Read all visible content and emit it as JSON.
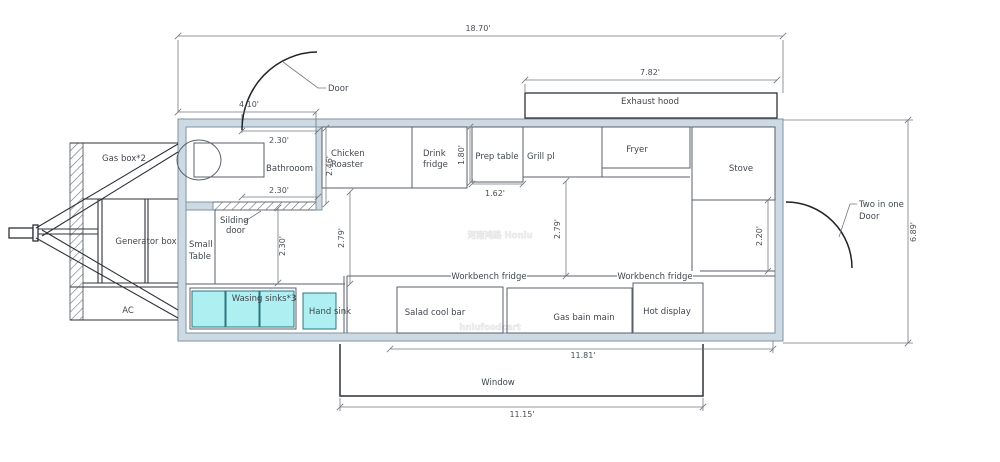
{
  "meta": {
    "description": "Food trailer floor plan CAD drawing",
    "width": 1000,
    "height": 462
  },
  "colors": {
    "wall_fill": "#cdd9e3",
    "wall_stroke": "#7f93a2",
    "unit_stroke": "#596068",
    "dark_stroke": "#2e3237",
    "dim_stroke": "#74797f",
    "sink_fill": "#aeeff1",
    "sink_stroke": "#2b7680",
    "text": "#41474e",
    "background": "#ffffff"
  },
  "walls": {
    "outer": {
      "x": 178,
      "y": 119,
      "w": 605,
      "h": 222
    },
    "inner": {
      "x": 186,
      "y": 127,
      "w": 589,
      "h": 206
    }
  },
  "boxes": [
    {
      "n": "annex-hatch-strip",
      "x": 70,
      "y": 143,
      "w": 13,
      "h": 177,
      "cls": "hatch"
    },
    {
      "n": "sliding-door-hatch",
      "x": 213,
      "y": 202,
      "w": 105,
      "h": 8,
      "cls": "hatch"
    },
    {
      "n": "bathroom-partition-wall",
      "x": 316,
      "y": 127,
      "w": 6,
      "h": 83,
      "cls": "wall"
    },
    {
      "n": "bathroom-wall-stub",
      "x": 186,
      "y": 202,
      "w": 27,
      "h": 8,
      "cls": "wall"
    },
    {
      "n": "toilet-tank",
      "x": 194,
      "y": 143,
      "w": 70,
      "h": 34,
      "cls": "unit-open"
    },
    {
      "n": "chicken-roaster-box",
      "x": 322,
      "y": 127,
      "w": 90,
      "h": 61,
      "cls": "unit"
    },
    {
      "n": "drink-fridge-box",
      "x": 412,
      "y": 127,
      "w": 55,
      "h": 61,
      "cls": "unit"
    },
    {
      "n": "prep-table-box",
      "x": 472,
      "y": 127,
      "w": 51,
      "h": 55,
      "cls": "unit"
    },
    {
      "n": "grill-box",
      "x": 523,
      "y": 127,
      "w": 79,
      "h": 50,
      "cls": "unit"
    },
    {
      "n": "fryer-box",
      "x": 602,
      "y": 127,
      "w": 88,
      "h": 41,
      "cls": "unit"
    },
    {
      "n": "stove-box",
      "x": 692,
      "y": 127,
      "w": 83,
      "h": 73,
      "cls": "unit"
    },
    {
      "n": "exhaust-hood-box",
      "x": 525,
      "y": 93,
      "w": 252,
      "h": 25,
      "cls": "dark"
    },
    {
      "n": "sink-unit-box",
      "x": 190,
      "y": 288,
      "w": 106,
      "h": 41,
      "cls": "unit"
    },
    {
      "n": "wash-sink-1",
      "x": 192,
      "y": 291,
      "w": 33,
      "h": 36,
      "cls": "sink"
    },
    {
      "n": "wash-sink-2",
      "x": 226,
      "y": 291,
      "w": 33,
      "h": 36,
      "cls": "sink"
    },
    {
      "n": "wash-sink-3",
      "x": 260,
      "y": 291,
      "w": 34,
      "h": 36,
      "cls": "sink"
    },
    {
      "n": "hand-sink-box",
      "x": 303,
      "y": 293,
      "w": 33,
      "h": 36,
      "cls": "sink"
    },
    {
      "n": "salad-cool-bar-box",
      "x": 397,
      "y": 287,
      "w": 106,
      "h": 46,
      "cls": "unit"
    },
    {
      "n": "gas-bain-main-box",
      "x": 507,
      "y": 288,
      "w": 125,
      "h": 45,
      "cls": "unit"
    },
    {
      "n": "hot-display-box",
      "x": 633,
      "y": 283,
      "w": 70,
      "h": 50,
      "cls": "unit"
    },
    {
      "n": "hitch-coupler",
      "x": 9,
      "y": 228,
      "w": 24,
      "h": 10,
      "cls": "dark"
    },
    {
      "n": "hitch-post",
      "x": 33,
      "y": 225,
      "w": 5,
      "h": 16,
      "cls": "dark"
    }
  ],
  "ellipses": [
    {
      "n": "toilet-bowl",
      "cx": 199,
      "cy": 160,
      "rx": 22,
      "ry": 20,
      "cls": "unit-open"
    }
  ],
  "lines": [
    {
      "n": "counter-edge-line",
      "x1": 186,
      "y1": 284,
      "x2": 345,
      "y2": 284,
      "cls": "line"
    },
    {
      "n": "small-table-divider",
      "x1": 215,
      "y1": 210,
      "x2": 215,
      "y2": 284,
      "cls": "line"
    },
    {
      "n": "fryer-front-line",
      "x1": 602,
      "y1": 177,
      "x2": 690,
      "y2": 177,
      "cls": "line"
    },
    {
      "n": "stove-front-line",
      "x1": 692,
      "y1": 200,
      "x2": 775,
      "y2": 200,
      "cls": "line"
    },
    {
      "n": "stove-counter-line",
      "x1": 692,
      "y1": 200,
      "x2": 692,
      "y2": 276,
      "cls": "line"
    },
    {
      "n": "workbench-top-line",
      "x1": 347,
      "y1": 276,
      "x2": 775,
      "y2": 276,
      "cls": "line"
    },
    {
      "n": "workbench-left-line-a",
      "x1": 344,
      "y1": 276,
      "x2": 344,
      "y2": 333,
      "cls": "line"
    },
    {
      "n": "workbench-left-line-b",
      "x1": 347,
      "y1": 276,
      "x2": 347,
      "y2": 333,
      "cls": "line"
    },
    {
      "n": "side-door-opening-line",
      "x1": 700,
      "y1": 271,
      "x2": 775,
      "y2": 271,
      "cls": "line"
    },
    {
      "n": "annex-top-line",
      "x1": 70,
      "y1": 143,
      "x2": 178,
      "y2": 143,
      "cls": "ann"
    },
    {
      "n": "annex-bottom-line",
      "x1": 70,
      "y1": 320,
      "x2": 178,
      "y2": 320,
      "cls": "ann"
    },
    {
      "n": "gasbox-bottom-line",
      "x1": 83,
      "y1": 199,
      "x2": 178,
      "y2": 199,
      "cls": "ann"
    },
    {
      "n": "generator-bottom-line",
      "x1": 83,
      "y1": 283,
      "x2": 178,
      "y2": 283,
      "cls": "ann"
    },
    {
      "n": "ac-top-line",
      "x1": 70,
      "y1": 287,
      "x2": 178,
      "y2": 287,
      "cls": "ann"
    },
    {
      "n": "frame-post-left-a",
      "x1": 98,
      "y1": 199,
      "x2": 98,
      "y2": 283,
      "cls": "ann"
    },
    {
      "n": "frame-post-left-b",
      "x1": 102,
      "y1": 199,
      "x2": 102,
      "y2": 283,
      "cls": "ann"
    },
    {
      "n": "frame-post-right-a",
      "x1": 145,
      "y1": 199,
      "x2": 145,
      "y2": 283,
      "cls": "ann"
    },
    {
      "n": "frame-post-right-b",
      "x1": 148,
      "y1": 199,
      "x2": 148,
      "y2": 283,
      "cls": "ann"
    },
    {
      "n": "drawbar-top",
      "x1": 38,
      "y1": 229,
      "x2": 98,
      "y2": 229,
      "cls": "ann"
    },
    {
      "n": "drawbar-bottom",
      "x1": 38,
      "y1": 234,
      "x2": 98,
      "y2": 234,
      "cls": "ann"
    },
    {
      "n": "hitch-beam-top-a",
      "x1": 36,
      "y1": 228,
      "x2": 178,
      "y2": 144,
      "cls": "ann"
    },
    {
      "n": "hitch-beam-top-b",
      "x1": 42,
      "y1": 236,
      "x2": 178,
      "y2": 152,
      "cls": "ann"
    },
    {
      "n": "hitch-beam-bottom-a",
      "x1": 36,
      "y1": 238,
      "x2": 178,
      "y2": 318,
      "cls": "ann"
    },
    {
      "n": "hitch-beam-bottom-b",
      "x1": 42,
      "y1": 230,
      "x2": 178,
      "y2": 310,
      "cls": "ann"
    },
    {
      "n": "ext-line-left-top",
      "x1": 178,
      "y1": 40,
      "x2": 178,
      "y2": 112,
      "cls": "dim"
    },
    {
      "n": "ext-line-right-top",
      "x1": 783,
      "y1": 40,
      "x2": 783,
      "y2": 93,
      "cls": "dim"
    },
    {
      "n": "ext-line-hood-left",
      "x1": 525,
      "y1": 84,
      "x2": 525,
      "y2": 93,
      "cls": "dim"
    },
    {
      "n": "ext-line-door-right",
      "x1": 316,
      "y1": 112,
      "x2": 316,
      "y2": 127,
      "cls": "dim"
    },
    {
      "n": "ext-line-door-left",
      "x1": 242,
      "y1": 114,
      "x2": 242,
      "y2": 133,
      "cls": "dim"
    },
    {
      "n": "ext-line-689-top",
      "x1": 783,
      "y1": 120,
      "x2": 913,
      "y2": 120,
      "cls": "dim"
    },
    {
      "n": "ext-line-689-bottom",
      "x1": 783,
      "y1": 343,
      "x2": 913,
      "y2": 343,
      "cls": "dim"
    },
    {
      "n": "ext-line-1181-right",
      "x1": 773,
      "y1": 341,
      "x2": 773,
      "y2": 353,
      "cls": "dim"
    },
    {
      "n": "ext-line-1115-left",
      "x1": 340,
      "y1": 398,
      "x2": 340,
      "y2": 411,
      "cls": "dim"
    },
    {
      "n": "ext-line-1115-right",
      "x1": 703,
      "y1": 398,
      "x2": 703,
      "y2": 411,
      "cls": "dim"
    }
  ],
  "paths": [
    {
      "n": "entry-door-arc",
      "d": "M242,130 A76,78 0 0 1 317,52",
      "cls": "arc"
    },
    {
      "n": "side-door-arc",
      "d": "M786,202 A66,66 0 0 1 852,268",
      "cls": "arc"
    },
    {
      "n": "window-outline",
      "d": "M340,344 L340,396 L703,396 L703,344",
      "cls": "darkline"
    },
    {
      "n": "door-leader",
      "d": "M283,62 L318,88 L326,88",
      "cls": "dim"
    },
    {
      "n": "sliding-door-leader",
      "d": "M244,222 L261,211",
      "cls": "dim"
    },
    {
      "n": "two-in-one-door-leader",
      "d": "M839,237 L850,204 L857,204",
      "cls": "dim"
    }
  ],
  "dims": [
    {
      "n": "dim-overall-length",
      "x1": 178,
      "y1": 36,
      "x2": 783,
      "y2": 36,
      "t": "18.70'",
      "lx": 478,
      "ly": 31
    },
    {
      "n": "dim-hood-length",
      "x1": 525,
      "y1": 80,
      "x2": 777,
      "y2": 80,
      "t": "7.82'",
      "lx": 650,
      "ly": 75
    },
    {
      "n": "dim-front-section",
      "x1": 178,
      "y1": 112,
      "x2": 316,
      "y2": 112,
      "t": "4.10'",
      "lx": 249,
      "ly": 107
    },
    {
      "n": "dim-bathroom-door-top",
      "x1": 242,
      "y1": 131,
      "x2": 318,
      "y2": 131,
      "t": "2.30'",
      "lx": 279,
      "ly": 143
    },
    {
      "n": "dim-bathroom-door-bottom",
      "x1": 242,
      "y1": 197,
      "x2": 318,
      "y2": 197,
      "t": "2.30'",
      "lx": 279,
      "ly": 193
    },
    {
      "n": "dim-bathroom-depth",
      "x1": 326,
      "y1": 128,
      "x2": 326,
      "y2": 204,
      "t": "2.46'",
      "lx": 332,
      "ly": 166,
      "rot": 1
    },
    {
      "n": "dim-drink-fridge-depth",
      "x1": 470,
      "y1": 127,
      "x2": 470,
      "y2": 183,
      "t": "1.80'",
      "lx": 464,
      "ly": 155,
      "rot": 1
    },
    {
      "n": "dim-prep-table-width",
      "x1": 472,
      "y1": 184,
      "x2": 523,
      "y2": 184,
      "t": "1.62'",
      "lx": 495,
      "ly": 196
    },
    {
      "n": "dim-aisle-left",
      "x1": 350,
      "y1": 192,
      "x2": 350,
      "y2": 284,
      "t": "2.79'",
      "lx": 344,
      "ly": 238,
      "rot": 1
    },
    {
      "n": "dim-aisle-right",
      "x1": 566,
      "y1": 181,
      "x2": 566,
      "y2": 276,
      "t": "2.79'",
      "lx": 560,
      "ly": 229,
      "rot": 1
    },
    {
      "n": "dim-small-table-depth",
      "x1": 278,
      "y1": 208,
      "x2": 278,
      "y2": 283,
      "t": "2.30'",
      "lx": 285,
      "ly": 246,
      "rot": 1
    },
    {
      "n": "dim-side-door-width",
      "x1": 768,
      "y1": 200,
      "x2": 768,
      "y2": 271,
      "t": "2.20'",
      "lx": 762,
      "ly": 236,
      "rot": 1
    },
    {
      "n": "dim-overall-height",
      "x1": 908,
      "y1": 120,
      "x2": 908,
      "y2": 343,
      "t": "6.89'",
      "lx": 916,
      "ly": 232,
      "rot": 1
    },
    {
      "n": "dim-counter-length",
      "x1": 390,
      "y1": 349,
      "x2": 773,
      "y2": 349,
      "t": "11.81'",
      "lx": 583,
      "ly": 358
    },
    {
      "n": "dim-window-length",
      "x1": 340,
      "y1": 407,
      "x2": 703,
      "y2": 407,
      "t": "11.15'",
      "lx": 522,
      "ly": 417
    }
  ],
  "texts": [
    {
      "n": "door-label",
      "x": 328,
      "y": 91,
      "t": "Door",
      "a": "start"
    },
    {
      "n": "bathroom-label",
      "x": 313,
      "y": 171,
      "t": "Bathrooom",
      "a": "end"
    },
    {
      "n": "chicken-roaster-label-1",
      "x": 331,
      "y": 156,
      "t": "Chicken",
      "a": "start"
    },
    {
      "n": "chicken-roaster-label-2",
      "x": 331,
      "y": 167,
      "t": "Roaster",
      "a": "start"
    },
    {
      "n": "drink-fridge-label-1",
      "x": 423,
      "y": 156,
      "t": "Drink",
      "a": "start"
    },
    {
      "n": "drink-fridge-label-2",
      "x": 423,
      "y": 167,
      "t": "fridge",
      "a": "start"
    },
    {
      "n": "prep-table-label",
      "x": 497,
      "y": 159,
      "t": "Prep table"
    },
    {
      "n": "grill-label",
      "x": 527,
      "y": 159,
      "t": "Grill pl",
      "a": "start"
    },
    {
      "n": "fryer-label",
      "x": 637,
      "y": 152,
      "t": "Fryer"
    },
    {
      "n": "exhaust-hood-label",
      "x": 650,
      "y": 104,
      "t": "Exhaust hood"
    },
    {
      "n": "stove-label",
      "x": 741,
      "y": 171,
      "t": "Stove"
    },
    {
      "n": "two-in-one-door-label-1",
      "x": 859,
      "y": 207,
      "t": "Two in one",
      "a": "start"
    },
    {
      "n": "two-in-one-door-label-2",
      "x": 859,
      "y": 219,
      "t": "Door",
      "a": "start"
    },
    {
      "n": "gas-box-label",
      "x": 124,
      "y": 161,
      "t": "Gas box*2"
    },
    {
      "n": "generator-box-label",
      "x": 146,
      "y": 244,
      "t": "Generator box"
    },
    {
      "n": "ac-label",
      "x": 128,
      "y": 313,
      "t": "AC"
    },
    {
      "n": "small-table-label-1",
      "x": 189,
      "y": 247,
      "t": "Small",
      "a": "start"
    },
    {
      "n": "small-table-label-2",
      "x": 189,
      "y": 259,
      "t": "Table",
      "a": "start"
    },
    {
      "n": "sliding-door-label-1",
      "x": 220,
      "y": 223,
      "t": "Silding",
      "a": "start"
    },
    {
      "n": "sliding-door-label-2",
      "x": 226,
      "y": 233,
      "t": "door",
      "a": "start"
    },
    {
      "n": "washing-sinks-label",
      "x": 264,
      "y": 301,
      "t": "Wasing sinks*3"
    },
    {
      "n": "hand-sink-label",
      "x": 330,
      "y": 314,
      "t": "Hand sink"
    },
    {
      "n": "workbench-fridge-label-1",
      "x": 489,
      "y": 279,
      "t": "Workbench fridge",
      "bg": 76
    },
    {
      "n": "workbench-fridge-label-2",
      "x": 655,
      "y": 279,
      "t": "Workbench fridge",
      "bg": 76
    },
    {
      "n": "salad-cool-bar-label",
      "x": 435,
      "y": 315,
      "t": "Salad cool bar"
    },
    {
      "n": "gas-bain-main-label",
      "x": 584,
      "y": 320,
      "t": "Gas bain main"
    },
    {
      "n": "hot-display-label",
      "x": 667,
      "y": 314,
      "t": "Hot display"
    },
    {
      "n": "window-label",
      "x": 498,
      "y": 385,
      "t": "Window"
    },
    {
      "n": "watermark-line-1",
      "x": 500,
      "y": 238,
      "t": "河南鸿路 Honlu",
      "cls": "wm",
      "size": 54
    },
    {
      "n": "watermark-line-2",
      "x": 490,
      "y": 330,
      "t": "hnlufoodcart",
      "cls": "wm",
      "size": 60
    }
  ]
}
